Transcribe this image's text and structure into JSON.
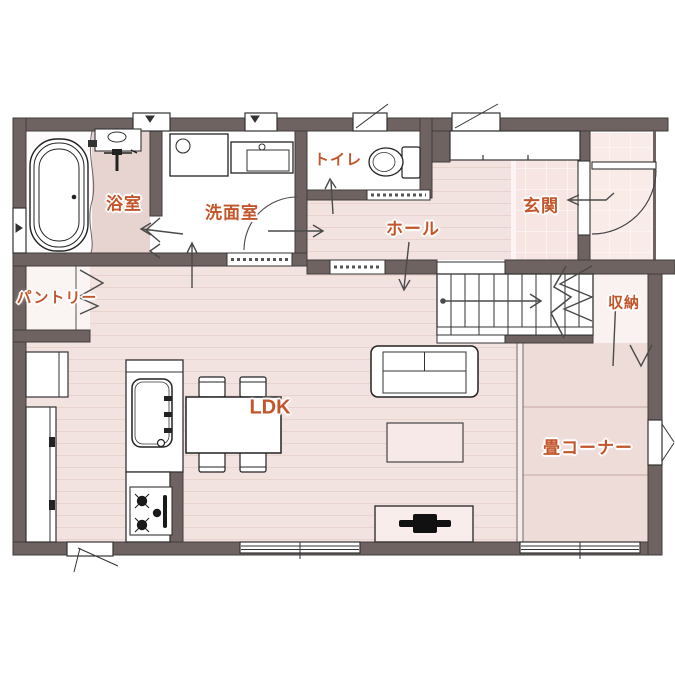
{
  "plan": {
    "type": "floor-plan",
    "floor": "1F",
    "rooms": [
      {
        "id": "bathroom",
        "label": "浴室"
      },
      {
        "id": "washroom",
        "label": "洗面室"
      },
      {
        "id": "toilet",
        "label": "トイレ"
      },
      {
        "id": "hall",
        "label": "ホール"
      },
      {
        "id": "entrance",
        "label": "玄関"
      },
      {
        "id": "pantry",
        "label": "パントリー"
      },
      {
        "id": "storage",
        "label": "収納"
      },
      {
        "id": "ldk",
        "label": "LDK"
      },
      {
        "id": "tatami",
        "label": "畳コーナー"
      }
    ],
    "fixtures": [
      "bathtub",
      "shower-unit",
      "vanity-sink",
      "washer-pan",
      "toilet-bowl",
      "shoe-cabinet",
      "kitchen-sink",
      "gas-stove",
      "dining-table",
      "chairs",
      "sofa",
      "coffee-table",
      "tv-board",
      "staircase",
      "pantry-shelf",
      "tall-cabinet",
      "front-door"
    ],
    "colors": {
      "wall": "#6f6361",
      "label": "#c4552a",
      "wood_floor": "#f3e3e0",
      "plank_line": "#e8d3cf",
      "tatami": "#eedcd9",
      "bathroom_floor": "#e7d3cf",
      "tile": "#f6e5e2",
      "outline": "#333333",
      "arrow": "#4a4a4a"
    }
  }
}
